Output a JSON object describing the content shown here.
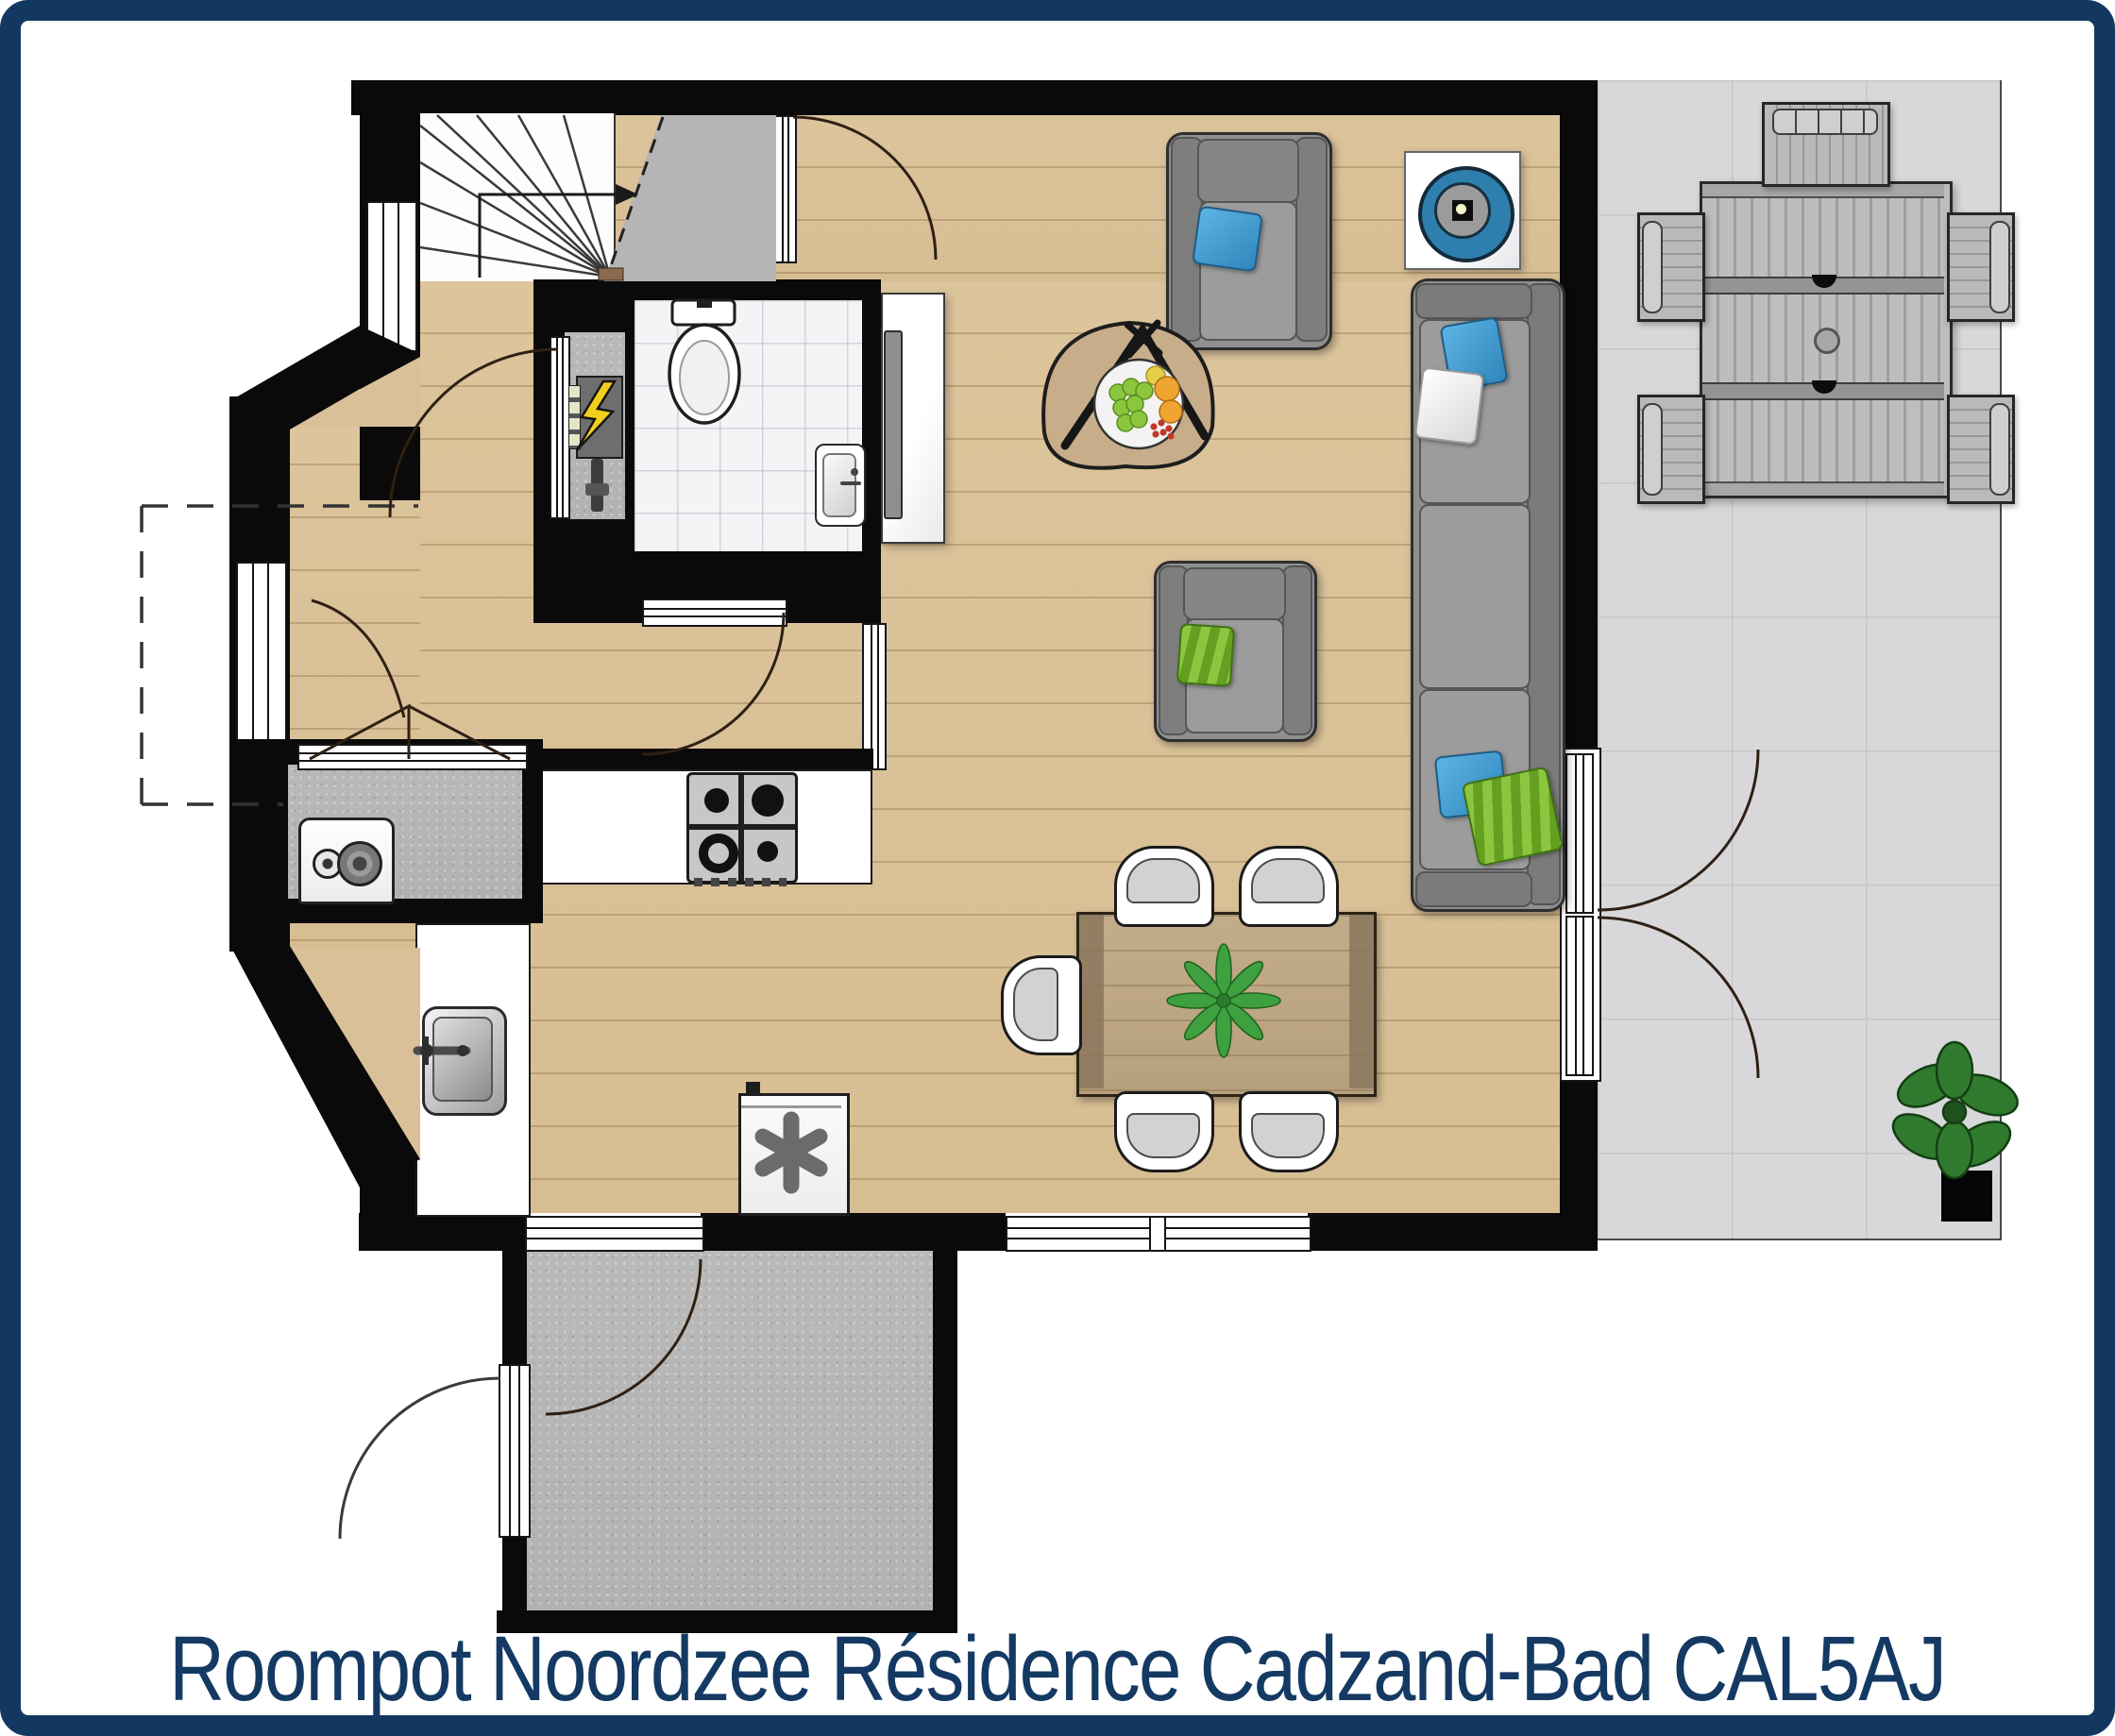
{
  "title": {
    "text": "Roompot Noordzee Résidence Cadzand-Bad CAL5AJ"
  },
  "palette": {
    "frame_navy": "#123862",
    "title_navy": "#143a63",
    "wall_black": "#0a0a0a",
    "wood_floor": "#dcc49c",
    "concrete_gray": "#b9b9b9",
    "terrace_tile": "#d8d8da",
    "accent_blue": "#3d9bd1",
    "accent_green": "#7cb82f"
  },
  "symbols": {
    "ventilation_unit": "✱",
    "electric_panel": "⚡",
    "stairs_direction": "up-arrow"
  },
  "rooms": [
    {
      "name": "living-dining-room",
      "floor": "wood"
    },
    {
      "name": "kitchen-corner",
      "floor": "wood"
    },
    {
      "name": "hallway",
      "floor": "wood"
    },
    {
      "name": "toilet-bathroom",
      "floor": "white-tile"
    },
    {
      "name": "technical-closet",
      "floor": "concrete"
    },
    {
      "name": "utility-closet-washer",
      "floor": "concrete"
    },
    {
      "name": "entrance-porch",
      "floor": "concrete"
    },
    {
      "name": "stair-landing",
      "floor": "concrete"
    },
    {
      "name": "terrace",
      "floor": "tile"
    }
  ],
  "furniture": {
    "living": [
      "armchair-with-blue-pillow",
      "armchair-with-green-pillow",
      "three-seat-sofa",
      "round-speaker-decor",
      "triangle-coffee-table-with-fruit-bowl",
      "tv-cabinet-with-tv"
    ],
    "dining": [
      "wooden-dining-table",
      "table-plant",
      "dining-chairs-x5"
    ],
    "kitchen": [
      "counter-with-gas-hob",
      "counter-with-sink",
      "washing-machine",
      "ventilation-unit"
    ],
    "bathroom": [
      "toilet",
      "hand-basin"
    ],
    "terrace": [
      "slatted-garden-table",
      "garden-chairs-x5",
      "green-plant",
      "black-post"
    ]
  },
  "counts": {
    "dining_chairs": 5,
    "terrace_chairs": 5,
    "windows": 8,
    "door_swings": 8
  }
}
